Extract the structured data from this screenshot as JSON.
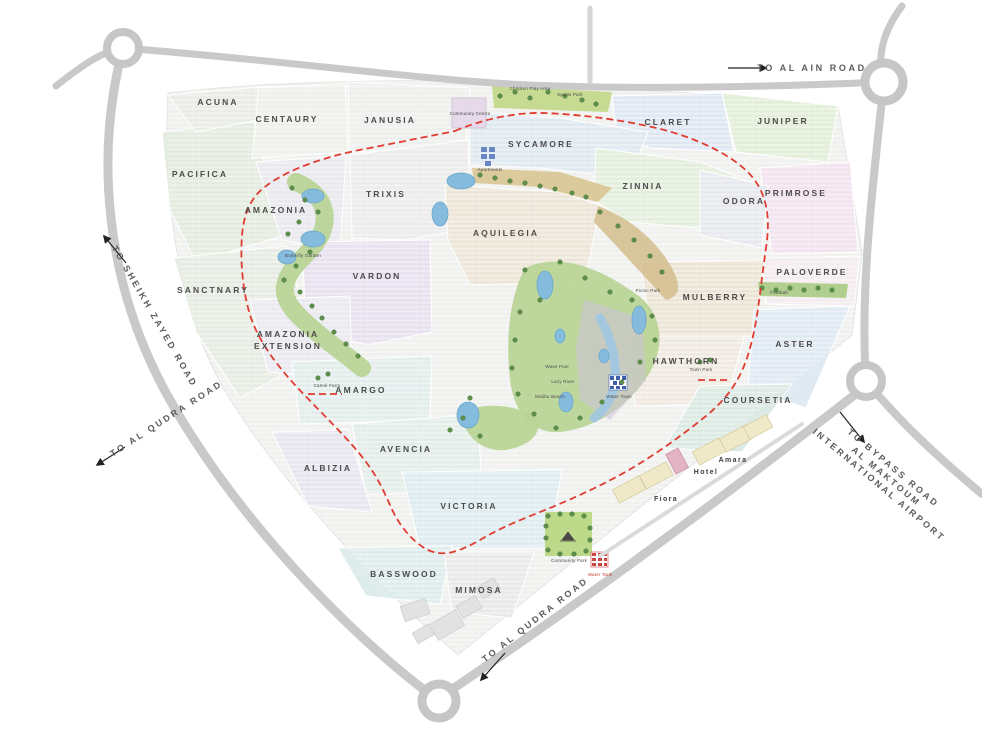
{
  "map": {
    "road_labels": {
      "al_ain": "TO AL AIN ROAD",
      "sheikh_zayed": "TO SHEIKH ZAYED ROAD",
      "al_qudra_west": "TO AL QUDRA ROAD",
      "al_qudra_south": "TO AL QUDRA ROAD",
      "bypass_line1": "TO BYPASS ROAD",
      "bypass_line2": "AL MAKTOUM",
      "bypass_line3": "INTERNATIONAL AIRPORT"
    },
    "clusters": [
      {
        "name": "ACUNA"
      },
      {
        "name": "CENTAURY"
      },
      {
        "name": "JANUSIA"
      },
      {
        "name": "CLARET"
      },
      {
        "name": "JUNIPER"
      },
      {
        "name": "PACIFICA"
      },
      {
        "name": "SYCAMORE"
      },
      {
        "name": "TRIXIS"
      },
      {
        "name": "ZINNIA"
      },
      {
        "name": "PRIMROSE"
      },
      {
        "name": "AMAZONIA"
      },
      {
        "name": "ODORA"
      },
      {
        "name": "AQUILEGIA"
      },
      {
        "name": "VARDON"
      },
      {
        "name": "PALOVERDE"
      },
      {
        "name": "SANCTNARY"
      },
      {
        "name": "MULBERRY"
      },
      {
        "name": "AMAZONIA",
        "name2": "EXTENSION"
      },
      {
        "name": "HAWTHORN"
      },
      {
        "name": "ASTER"
      },
      {
        "name": "AMARGO"
      },
      {
        "name": "COURSETIA"
      },
      {
        "name": "AVENCIA"
      },
      {
        "name": "ALBIZIA"
      },
      {
        "name": "VICTORIA"
      },
      {
        "name": "BASSWOOD"
      },
      {
        "name": "MIMOSA"
      }
    ],
    "places": {
      "amara": "Amara",
      "hotel": "Hotel",
      "fiora": "Fiora"
    },
    "amenities": [
      {
        "name": "Community Centre"
      },
      {
        "name": "Children Play Area"
      },
      {
        "name": "Sports Park"
      },
      {
        "name": "Apartments"
      },
      {
        "name": "Butterfly Garden"
      },
      {
        "name": "Picnic Park"
      },
      {
        "name": "Wave Pool"
      },
      {
        "name": "Lazy River"
      },
      {
        "name": "Malibu Beach"
      },
      {
        "name": "Water Town"
      },
      {
        "name": "Camel Farm"
      },
      {
        "name": "Town Park"
      },
      {
        "name": "Football"
      },
      {
        "name": "Community Park"
      },
      {
        "name": "Water Tank"
      }
    ],
    "palette": {
      "boundary_red": "#e03c32",
      "road_grey": "#c9c9c9",
      "water_blue": "#85bbdc",
      "park_green": "#b7d392",
      "tree_green": "#5d8f4a",
      "sand_tan": "#d8c592",
      "arrow_black": "#222222"
    }
  }
}
